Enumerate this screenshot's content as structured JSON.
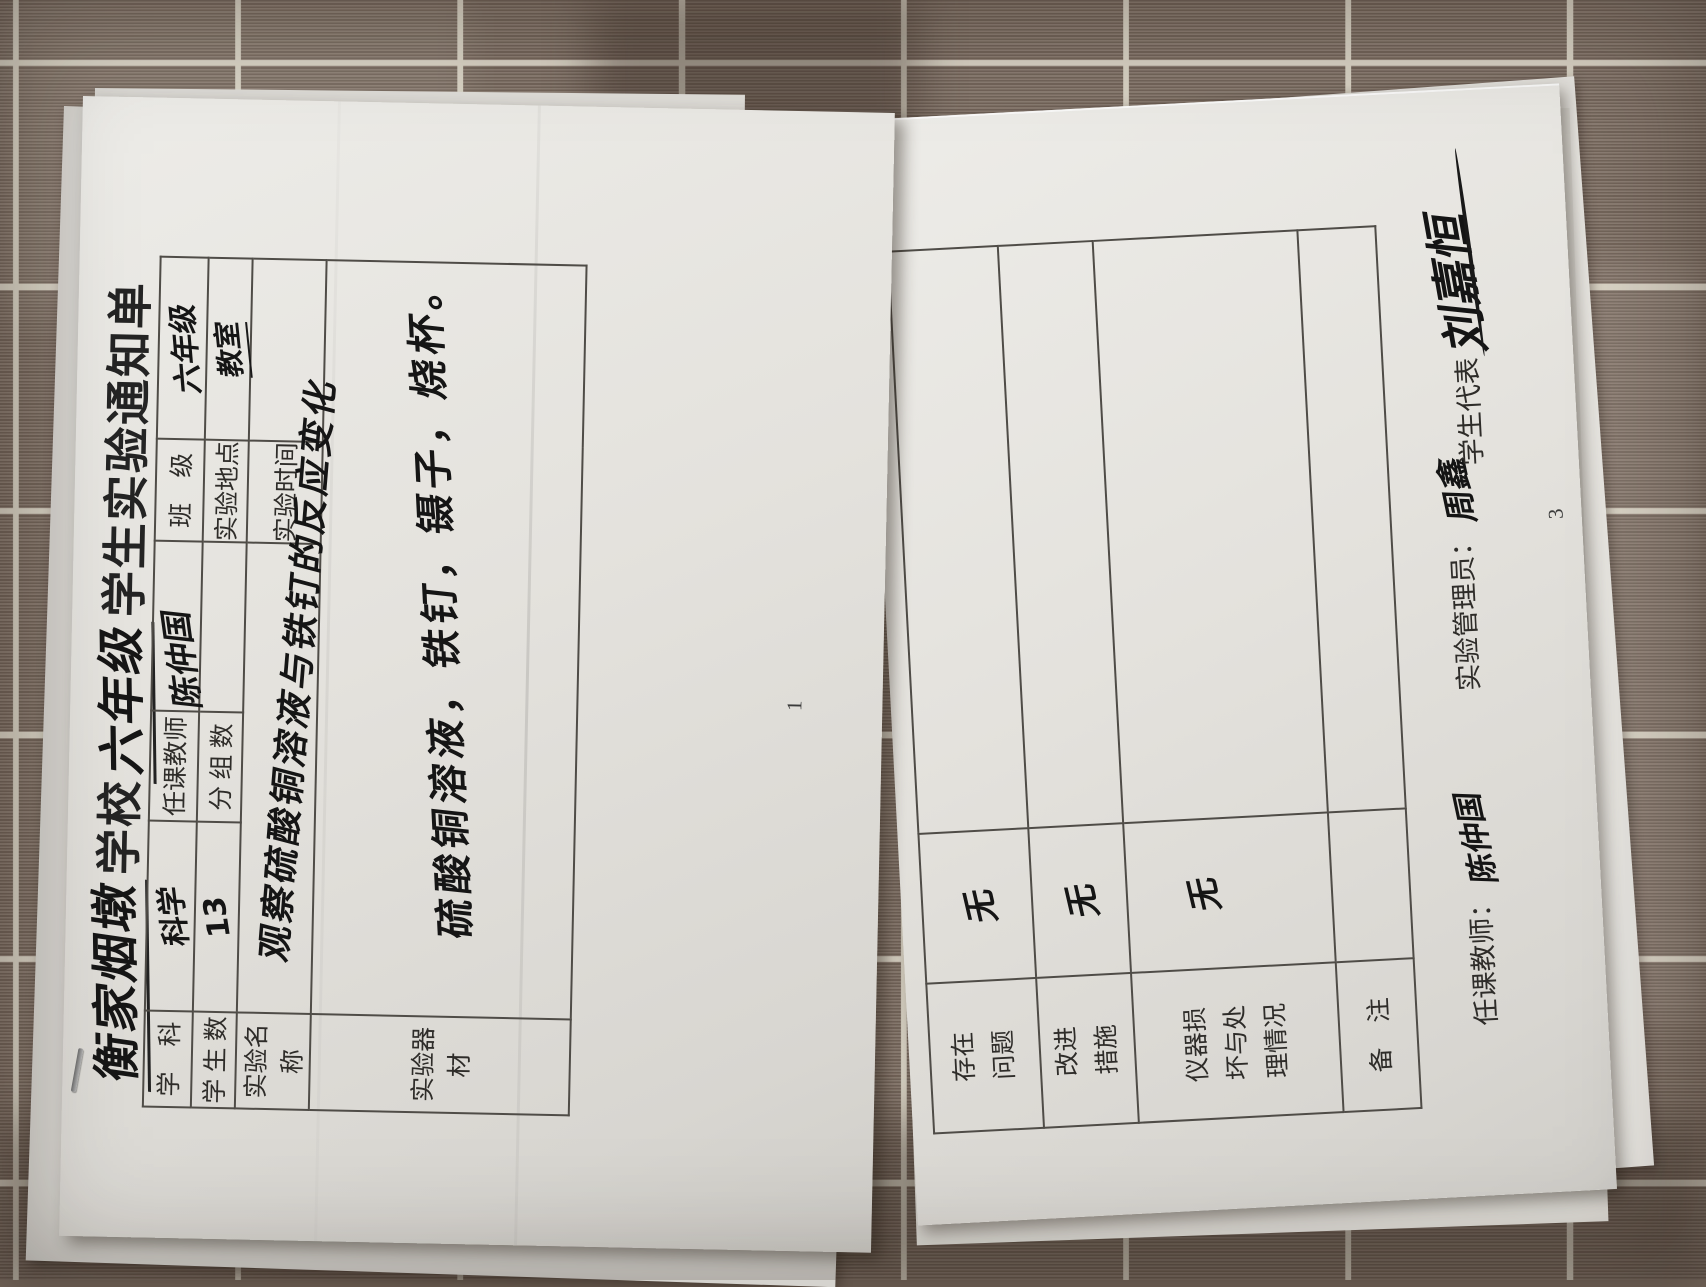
{
  "left_sheet": {
    "title": {
      "school_name_handwritten": "衡家烟墩",
      "school_suffix": "学校",
      "grade_handwritten": "六年级",
      "rest": "学生实验通知单"
    },
    "table": {
      "subject_label": "学　科",
      "subject_value": "科学",
      "teacher_label": "任课教师",
      "teacher_signature": "陈仲国",
      "class_label": "班　级",
      "class_value": "六年级",
      "student_count_label": "学 生 数",
      "student_count_value": "13",
      "group_count_label": "分 组 数",
      "group_count_value": "",
      "location_label": "实验地点",
      "location_value": "教室",
      "experiment_name_label": "实验名称",
      "experiment_name_value": "观察硫酸铜溶液与铁钉的反应变化",
      "time_label": "实验时间",
      "time_value": "",
      "equipment_label": "实验器材",
      "equipment_value": "硫酸铜溶液，铁钉，镊子，烧杯。"
    },
    "page_number": "1"
  },
  "right_sheet": {
    "rows": [
      {
        "label": "存在问题",
        "value": "无"
      },
      {
        "label": "改进措施",
        "value": "无"
      },
      {
        "label": "仪器损坏与处理情况",
        "value": "无"
      },
      {
        "label": "备　注",
        "value": ""
      }
    ],
    "signatures": {
      "teacher_label": "任课教师：",
      "teacher_signature": "陈仲国",
      "manager_label": "实验管理员：",
      "manager_signature": "周鑫",
      "student_label": "学生代表",
      "student_signature": "刘嘉恒"
    },
    "page_number": "3"
  }
}
